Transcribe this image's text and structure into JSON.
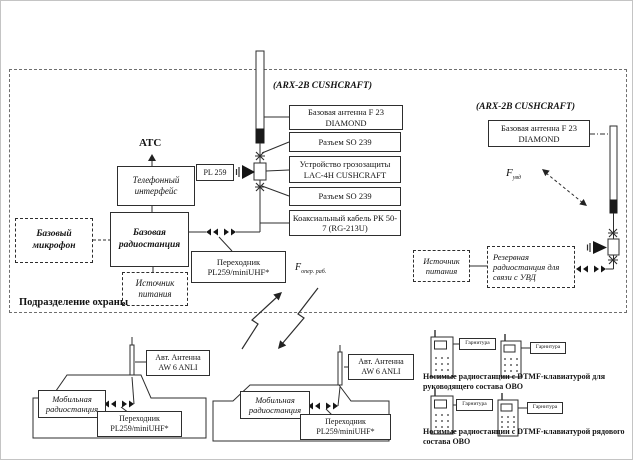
{
  "security_unit": {
    "label": "Подразделение охраны",
    "atc_label": "АТС",
    "telephone_interface": "Телефонный интерфейс",
    "base_microphone": "Базовый микрофон",
    "base_station": "Базовая радиостанция",
    "power_supply": "Источник питания",
    "adapter": "Переходник PL259/miniUHF*",
    "pl259_connector": "PL 259",
    "antenna_title": "(ARX-2B CUSHCRAFT)",
    "antenna_stack": [
      {
        "label": "Базовая антенна F 23 DIAMOND"
      },
      {
        "label": "Разъем SO 239"
      },
      {
        "label": "Устройство грозозащиты LAC-4H CUSHCRAFT"
      },
      {
        "label": "Разъем SO 239"
      },
      {
        "label": "Коаксиальный кабель РК 50-7 (RG-213U)"
      }
    ]
  },
  "reserve_section": {
    "antenna_title": "(ARX-2B CUSHCRAFT)",
    "base_antenna": "Базовая антенна F 23 DIAMOND",
    "power_supply": "Источник питания",
    "reserve_station": "Резервная радиостанция для связи с УВД",
    "uvd_frequency": {
      "symbol": "F",
      "sub": "увд"
    }
  },
  "radio_link": {
    "work_frequency": {
      "symbol": "F",
      "sub": "опер. раб."
    }
  },
  "mobile_units": [
    {
      "antenna": "Авт. Антенна AW 6 ANLI",
      "radio": "Мобильная радиостанция",
      "adapter": "Переходник PL259/miniUHF*"
    },
    {
      "antenna": "Авт. Антенна AW 6 ANLI",
      "radio": "Мобильная радиостанция",
      "adapter": "Переходник PL259/miniUHF*"
    }
  ],
  "portable_units": {
    "headset_label": "Гарнитура",
    "management_caption": "Носимые радиостанции с DTMF-клавиатурой для руководящего состава ОВО",
    "rank_caption": "Носимые радиостанции с DTMF-клавиатурой рядового состава ОВО"
  }
}
